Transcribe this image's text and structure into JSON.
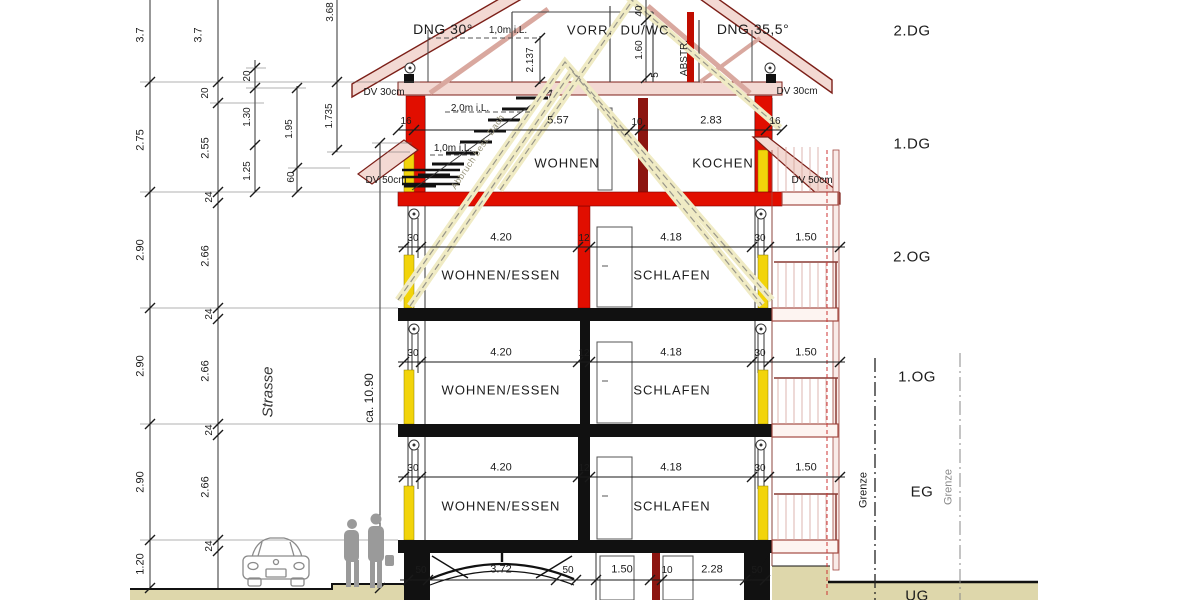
{
  "labels": {
    "dng_left": "DNG 30°",
    "dng_right": "DNG 35,5°",
    "vorr": "VORR.",
    "duwc": "DU/WC",
    "abstr": "ABSTR.",
    "wohnen": "WOHNEN",
    "kochen": "KOCHEN",
    "wohnen_essen": "WOHNEN/ESSEN",
    "schlafen": "SCHLAFEN",
    "strasse": "Strasse",
    "ca_height": "ca. 10.90",
    "grenze": "Grenze",
    "dv30": "DV 30cm",
    "dv50": "DV 50cm",
    "abbruch": "Abbruch best. Dach"
  },
  "floors": [
    "2.DG",
    "1.DG",
    "2.OG",
    "1.OG",
    "EG",
    "UG"
  ],
  "dims": {
    "colA": [
      "3.7",
      "2.75",
      "2.90",
      "2.90",
      "2.90",
      "1.20"
    ],
    "colB": [
      "3.7",
      "20",
      "2.55",
      "24",
      "2.66",
      "24",
      "2.66",
      "24",
      "2.66",
      "24"
    ],
    "colC": [
      "20",
      "1.30",
      "1.25"
    ],
    "colD": [
      "1.95",
      "60"
    ],
    "colE": [
      "3.68",
      "1.735"
    ],
    "attic": {
      "m1": "1,0m i.L.",
      "h2137": "2.137",
      "w40": "40",
      "h160": "1.60",
      "w5": "5"
    },
    "dg1": {
      "left16": "16",
      "right16": "16",
      "w557": "5.57",
      "w10": "10",
      "w283": "2.83",
      "m2": "2,0m i.L.",
      "m1": "1,0m i.L."
    },
    "floor_dims": [
      "30",
      "4.20",
      "12",
      "4.18",
      "30",
      "1.50"
    ],
    "ug_left": [
      "50",
      "3.72",
      "50"
    ],
    "ug_right": [
      "1.50",
      "10",
      "2.28",
      "50"
    ]
  },
  "colors": {
    "new_construction_red": "#e10e00",
    "roof_pink": "#f3d9d3",
    "roof_edge": "#7c1f18",
    "insulation_yellow": "#f2d40a",
    "ground_beige": "#ded7ab",
    "existing_black": "#111111",
    "demolition_halo": "#f0ebc4"
  }
}
